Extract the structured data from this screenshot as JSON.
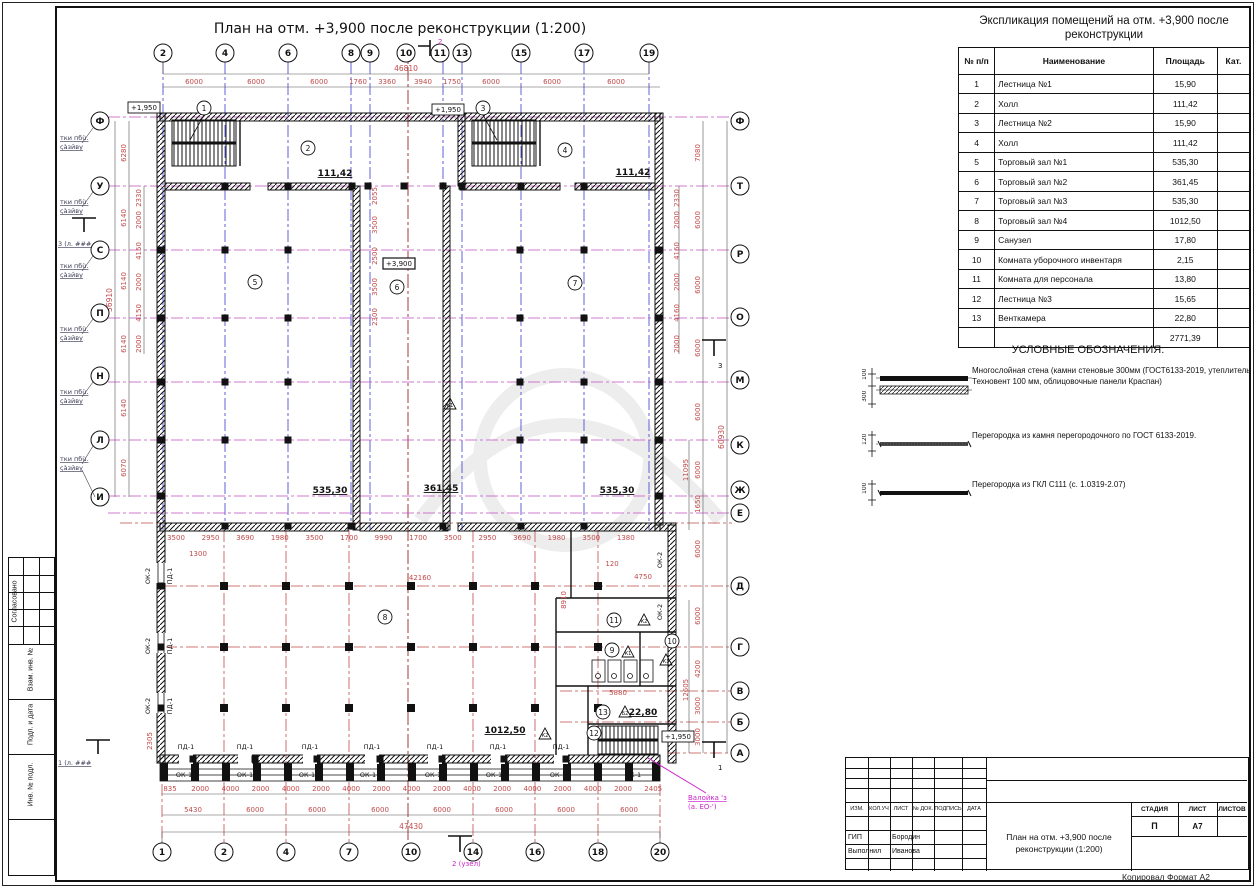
{
  "page": {
    "drawing_title": "План на отм. +3,900 после реконструкции (1:200)",
    "copied_note": "Копировал Формат А2"
  },
  "explication": {
    "title": "Экспликация помещений на отм. +3,900 после реконструкции",
    "columns": [
      "№ п/п",
      "Наименование",
      "Площадь",
      "Кат."
    ],
    "rows": [
      [
        "1",
        "Лестница №1",
        "15,90",
        ""
      ],
      [
        "2",
        "Холл",
        "111,42",
        ""
      ],
      [
        "3",
        "Лестница №2",
        "15,90",
        ""
      ],
      [
        "4",
        "Холл",
        "111,42",
        ""
      ],
      [
        "5",
        "Торговый зал №1",
        "535,30",
        ""
      ],
      [
        "6",
        "Торговый зал №2",
        "361,45",
        ""
      ],
      [
        "7",
        "Торговый зал №3",
        "535,30",
        ""
      ],
      [
        "8",
        "Торговый зал №4",
        "1012,50",
        ""
      ],
      [
        "9",
        "Санузел",
        "17,80",
        ""
      ],
      [
        "10",
        "Комната уборочного инвентаря",
        "2,15",
        ""
      ],
      [
        "11",
        "Комната для персонала",
        "13,80",
        ""
      ],
      [
        "12",
        "Лестница №3",
        "15,65",
        ""
      ],
      [
        "13",
        "Венткамера",
        "22,80",
        ""
      ],
      [
        "",
        "",
        "2771,39",
        ""
      ]
    ]
  },
  "legend": {
    "title": "УСЛОВНЫЕ ОБОЗНАЧЕНИЯ:",
    "items": [
      {
        "dims": [
          "100",
          "300"
        ],
        "text": "Многослойная стена (камни стеновые 300мм (ГОСТ6133-2019, утеплитель Техновент 100 мм, облицовочные панели Краспан)"
      },
      {
        "dims": [
          "120"
        ],
        "text": "Перегородка из камня перегородочного по ГОСТ 6133-2019."
      },
      {
        "dims": [
          "100"
        ],
        "text": "Перегородка из ГКЛ С111 (с. 1.0319-2.07)"
      }
    ]
  },
  "title_block": {
    "header_cells": [
      "ИЗМ.",
      "КОЛ.УЧ",
      "ЛИСТ",
      "№ ДОК.",
      "ПОДПИСЬ",
      "ДАТА"
    ],
    "stage_label": "СТАДИЯ",
    "sheet_label": "ЛИСТ",
    "sheets_label": "ЛИСТОВ",
    "stage": "П",
    "sheet": "А7",
    "sheets": "",
    "role1": "ГИП",
    "name1": "Бородин",
    "role2": "Выполнил",
    "name2": "Иванова",
    "doc_title": "План на отм. +3,900 после реконструкции (1:200)"
  },
  "side_strip": {
    "labels": [
      "Согласовано",
      "Взам. инв. №",
      "Подп. и дата",
      "Инв. № подл."
    ]
  },
  "plan": {
    "top_axes": [
      "2",
      "4",
      "6",
      "8",
      "9",
      "10",
      "11",
      "13",
      "15",
      "17",
      "19"
    ],
    "top_dims": [
      "6000",
      "6000",
      "6000",
      "1760",
      "3360",
      "3940",
      "1750",
      "6000",
      "6000",
      "6000"
    ],
    "top_total": "46810",
    "bottom_axes": [
      "1",
      "2",
      "4",
      "7",
      "10",
      "14",
      "16",
      "18",
      "20"
    ],
    "bottom_dims": [
      "5430",
      "6000",
      "6000",
      "6000",
      "6000",
      "6000",
      "6000",
      "6000"
    ],
    "bottom_total": "47430",
    "window_dims": [
      "835",
      "2000",
      "4000",
      "2000",
      "4000",
      "2000",
      "4000",
      "2000",
      "4000",
      "2000",
      "4000",
      "2000",
      "4000",
      "2000",
      "4000",
      "2000",
      "2405"
    ],
    "left_axes": [
      "Ф",
      "У",
      "С",
      "П",
      "Н",
      "Л",
      "И"
    ],
    "left_dims": [
      "6280",
      "6140",
      "6140",
      "6140",
      "6140",
      "6070"
    ],
    "left_total": "36910",
    "left_sub_dims": [
      "2330",
      "2000",
      "4150",
      "2000",
      "4150",
      "2000"
    ],
    "right_axes": [
      "Ф",
      "Т",
      "Р",
      "О",
      "М",
      "К",
      "Ж",
      "Е",
      "Д",
      "Г",
      "В",
      "Б",
      "А"
    ],
    "right_dims_upper": [
      "7080",
      "6000",
      "6000",
      "6000",
      "6000",
      "6000",
      "1650"
    ],
    "right_dims_lower": [
      "6000",
      "6000",
      "4200",
      "3000",
      "3000"
    ],
    "right_sub_dims": [
      "2330",
      "2000",
      "4160",
      "2000",
      "4160",
      "2000"
    ],
    "right_total": "60930",
    "inner_dims_bottom": [
      "3500",
      "2950",
      "3690",
      "1980",
      "3500",
      "1700",
      "9990",
      "1700",
      "3500",
      "2950",
      "3690",
      "1980",
      "3500",
      "1380"
    ],
    "inner_v_dims": [
      "2055",
      "3500",
      "2500",
      "3500",
      "2300"
    ],
    "misc_dims": {
      "d1300": "1300",
      "d42160": "42160",
      "d8910": "8910",
      "d120": "120",
      "d4750": "4750",
      "d5880": "5880",
      "d2305": "2305",
      "d12605": "12605",
      "d11095": "11095"
    },
    "rooms": {
      "r1": "1",
      "r2": "2",
      "r3": "3",
      "r4": "4",
      "r5": "5",
      "r6": "6",
      "r7": "7",
      "r8": "8",
      "r9": "9",
      "r10": "10",
      "r11": "11",
      "r12": "12",
      "r13": "13"
    },
    "areas": {
      "a2": "111,42",
      "a4": "111,42",
      "a5": "535,30",
      "a6": "361,45",
      "a7": "535,30",
      "a8": "1012,50",
      "a13": "22,80"
    },
    "elevations": {
      "e1": "+1,950",
      "e2": "+1,950",
      "e3": "+3,900",
      "e4": "+1,950"
    },
    "marks": {
      "k1": "К1",
      "k2": "К2",
      "k3": "К3",
      "b2": "Б2"
    },
    "labels": {
      "pd1": "ПД-1",
      "ok1": "ОК-1",
      "ok2": "ОК-2"
    },
    "sections": {
      "s2_top": "2",
      "s3_left": "3 (л. ###",
      "s3_right": "3",
      "s1_left": "1 (л. ###",
      "s1_right": "1",
      "s2_bottom": "2 (узел)"
    },
    "notes": {
      "line1": "тки пбù.",
      "line2": "çàзйву"
    },
    "callout": {
      "line1": "Валойка 'з",
      "line2": "(а. ЕО-')"
    }
  }
}
